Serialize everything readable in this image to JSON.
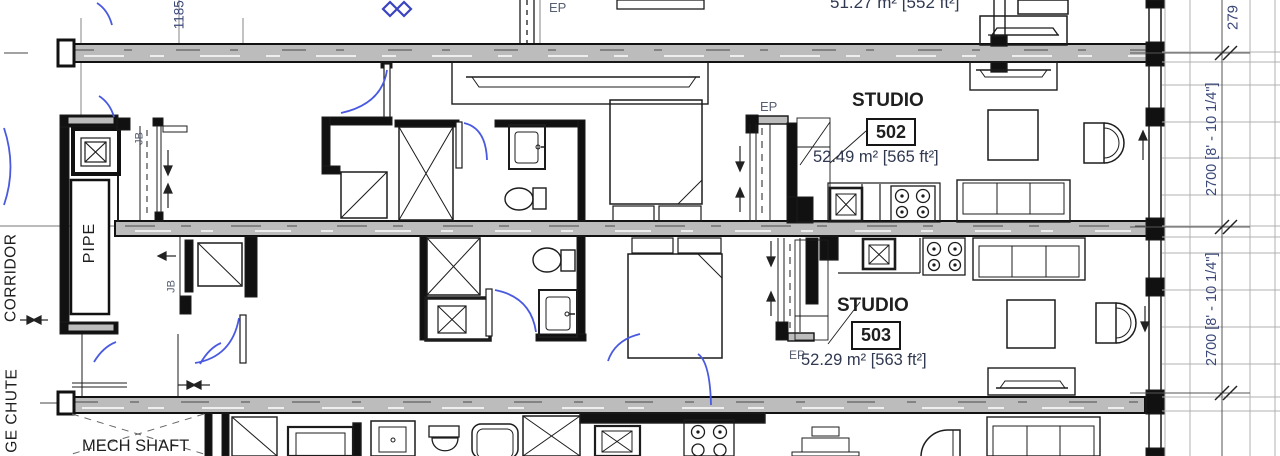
{
  "drawing": {
    "labels": {
      "corridor": "CORRIDOR",
      "garbage_chute": "GE CHUTE",
      "pipe": "PIPE",
      "mech_shaft": "MECH SHAFT",
      "jb": "JB",
      "ep": "EP"
    },
    "units": {
      "upper": {
        "area": "51.27 m² [552 ft²]"
      },
      "studio_502": {
        "name": "STUDIO",
        "number": "502",
        "area": "52.49 m² [565 ft²]"
      },
      "studio_503": {
        "name": "STUDIO",
        "number": "503",
        "area": "52.29 m² [563 ft²]"
      }
    },
    "dimensions": {
      "top_left": "1185",
      "right_top": "279",
      "right_upper": "2700 [8' - 10 1/4\"]",
      "right_lower": "2700 [8' - 10 1/4\"]"
    },
    "colors": {
      "wall_fill": "#bcbcbc",
      "line": "#1c1c1c",
      "annotation_text": "#2f3850",
      "dimension_text": "#3b4878",
      "door_swing": "#4a5ae0",
      "grid_line": "#b0b0b0"
    }
  }
}
